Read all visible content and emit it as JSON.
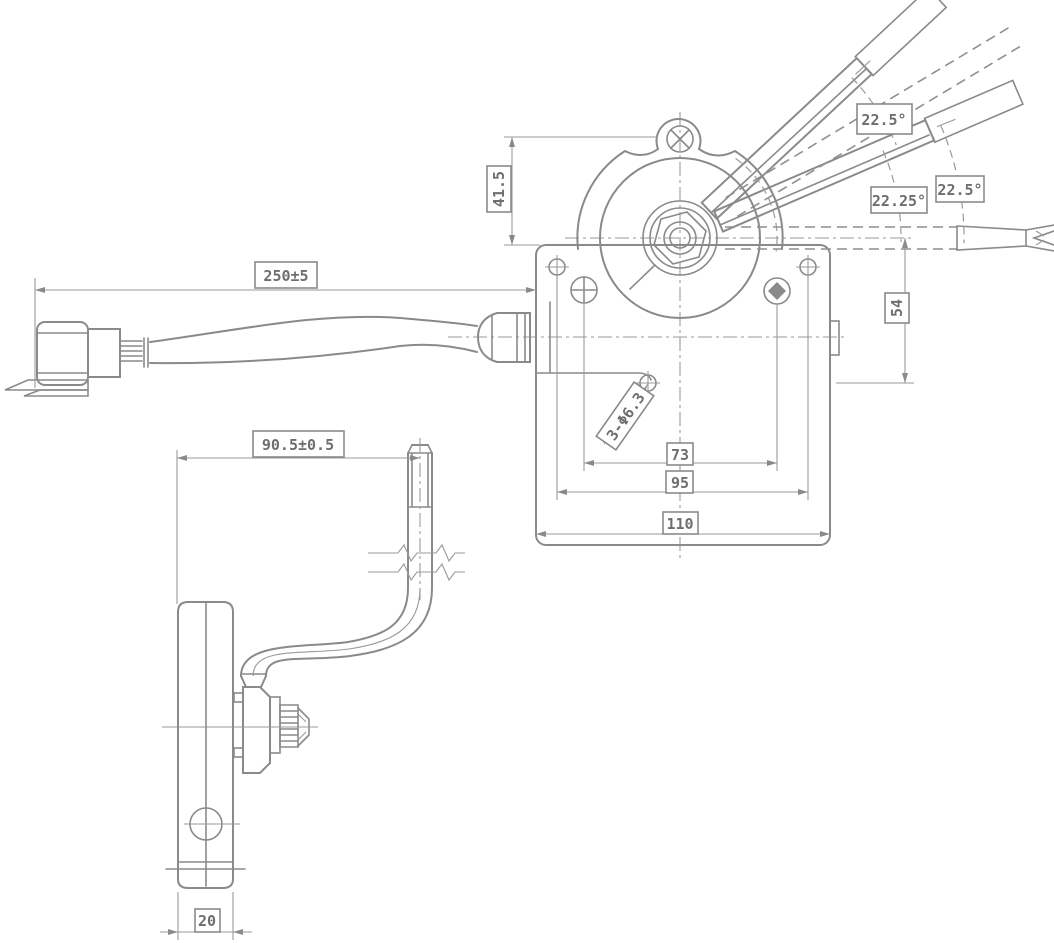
{
  "drawing": {
    "background": "#ffffff",
    "line_color": "#8a8a8a",
    "text_color": "#6e6e6e",
    "labels": {
      "cable_length": "250±5",
      "bracket_offset": "90.5±0.5",
      "ear_height": "41.5",
      "hole_drop": "54",
      "screw_spacing": "73",
      "hole_spacing": "95",
      "plate_width": "110",
      "mount_holes": "3-Φ6.3",
      "bar_width": "20",
      "angle_top": "22.5°",
      "angle_mid": "22.25°",
      "angle_right": "22.5°"
    }
  }
}
